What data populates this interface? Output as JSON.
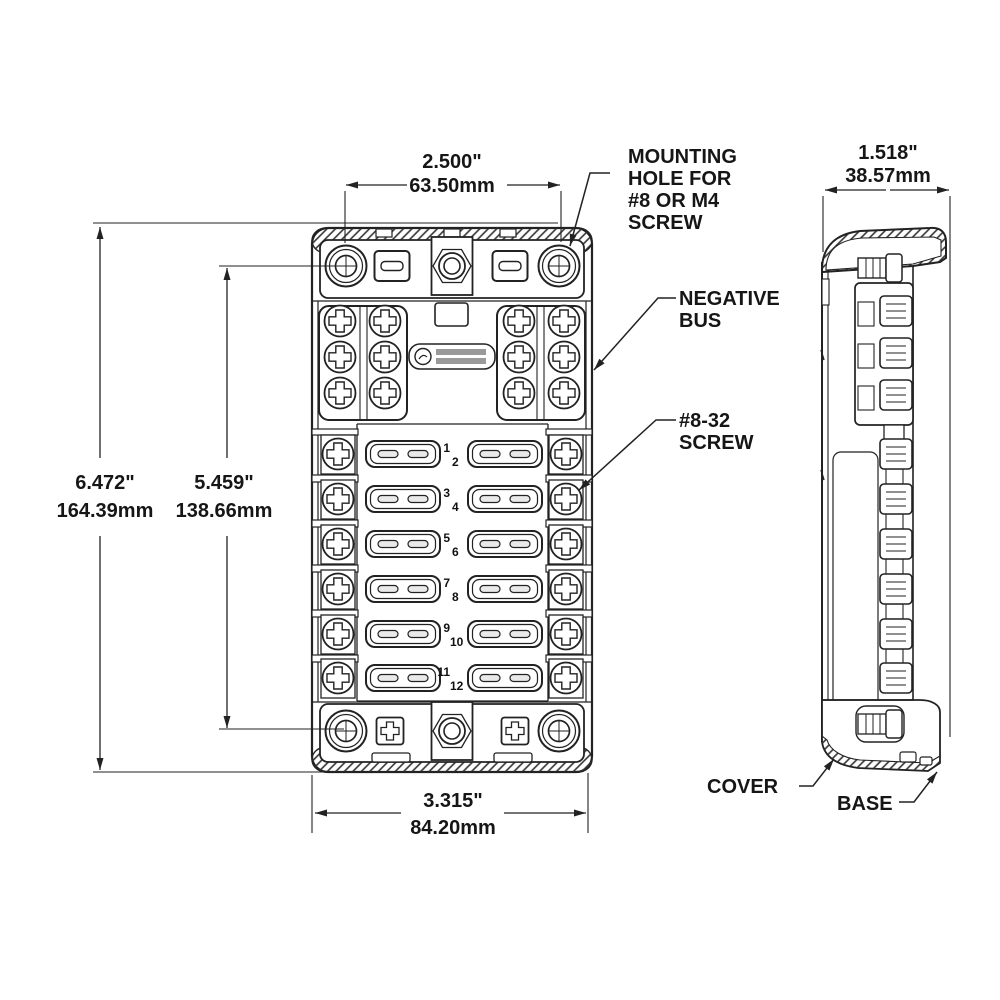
{
  "drawing": {
    "title_hint": "fuse block dimension drawing",
    "dimensions": {
      "top_width": {
        "in": "2.500\"",
        "mm": "63.50mm"
      },
      "side_depth": {
        "in": "1.518\"",
        "mm": "38.57mm"
      },
      "overall_height": {
        "in": "6.472\"",
        "mm": "164.39mm"
      },
      "hole_spacing": {
        "in": "5.459\"",
        "mm": "138.66mm"
      },
      "base_width": {
        "in": "3.315\"",
        "mm": "84.20mm"
      }
    },
    "callouts": {
      "mounting_hole": [
        "MOUNTING",
        "HOLE FOR",
        "#8 OR M4",
        "SCREW"
      ],
      "negative_bus": [
        "NEGATIVE",
        "BUS"
      ],
      "screw": [
        "#8-32",
        "SCREW"
      ],
      "cover": "COVER",
      "base": "BASE"
    },
    "fuse_numbers": [
      "1",
      "2",
      "3",
      "4",
      "5",
      "6",
      "7",
      "8",
      "9",
      "10",
      "11",
      "12"
    ],
    "ink_color": "#222222"
  }
}
